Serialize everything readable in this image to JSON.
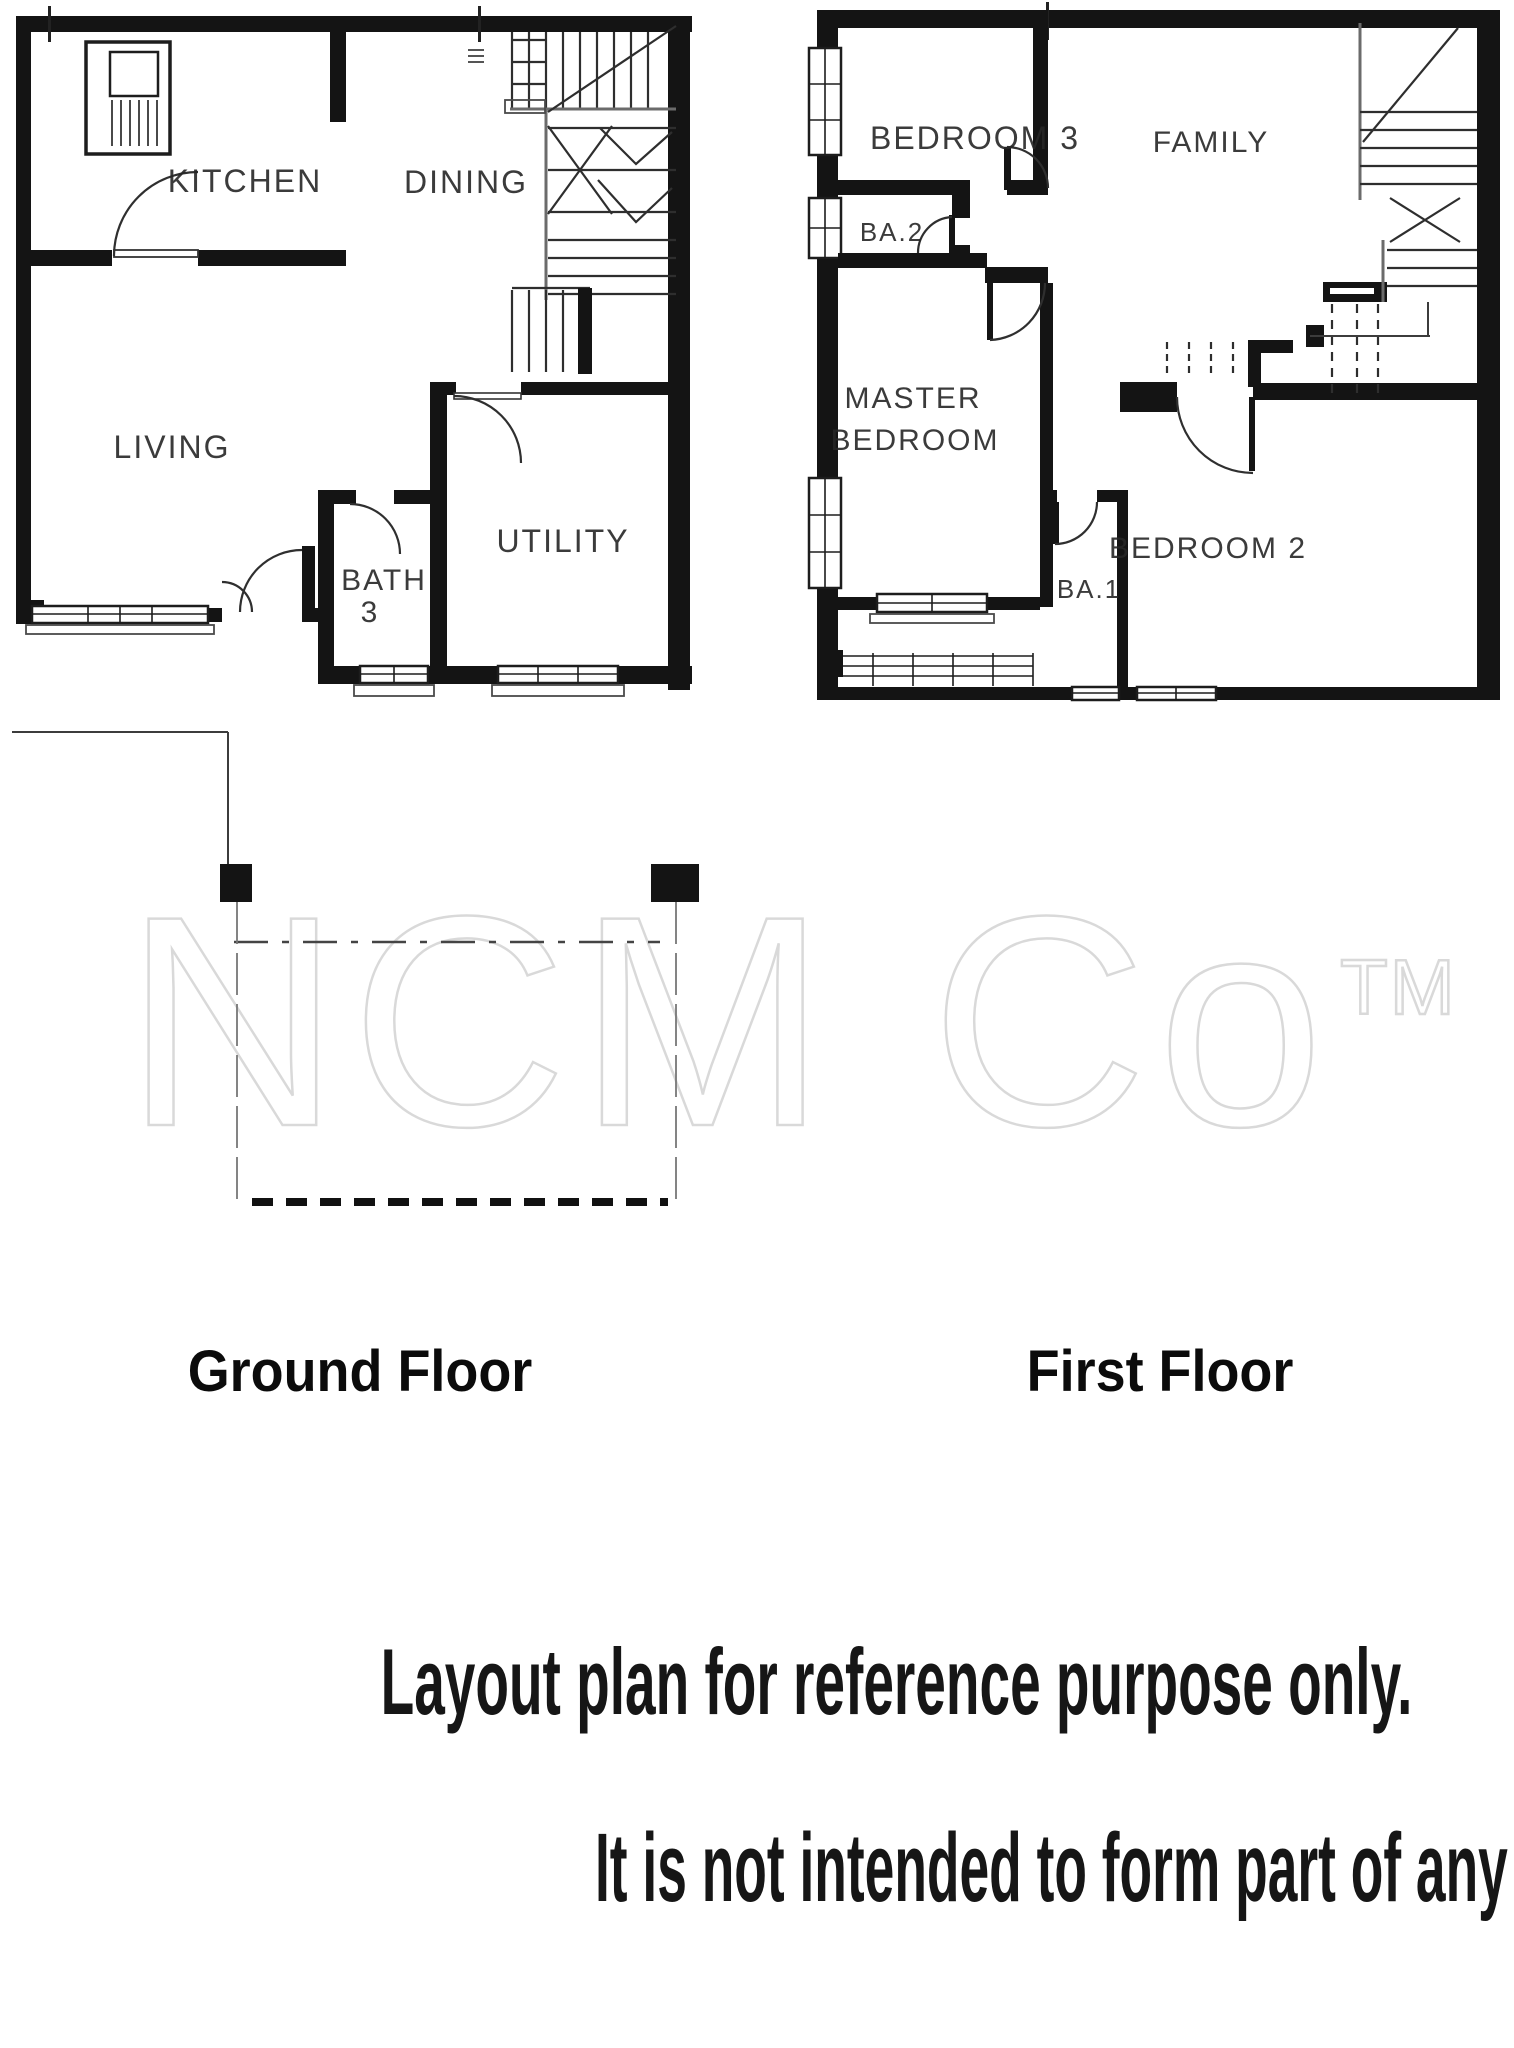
{
  "watermark": {
    "text": "NCM Co",
    "tm": "TM",
    "stroke_color": "#d9d9d9"
  },
  "ground_floor": {
    "title": "Ground Floor",
    "rooms": {
      "kitchen": "KITCHEN",
      "dining": "DINING",
      "living": "LIVING",
      "bath_line1": "BATH",
      "bath_line2": "3",
      "utility": "UTILITY"
    }
  },
  "first_floor": {
    "title": "First Floor",
    "rooms": {
      "bedroom3": "BEDROOM 3",
      "family": "FAMILY",
      "ba2": "BA.2",
      "master_line1": "MASTER",
      "master_line2": "BEDROOM",
      "ba1": "BA.1",
      "bedroom2": "BEDROOM 2"
    }
  },
  "disclaimer": {
    "line1": "Layout plan for reference purpose only.",
    "line2": "It is not intended to form part of any contract or warranty."
  },
  "colors": {
    "ink": "#141414",
    "paper": "#ffffff"
  }
}
